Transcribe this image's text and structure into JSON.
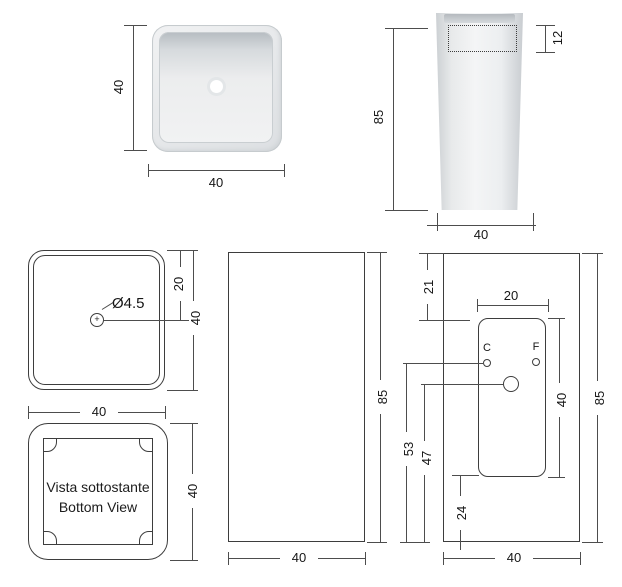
{
  "drawing": {
    "product": "square freestanding washbasin technical drawing",
    "colors": {
      "line": "#3d3d3d",
      "photo_gray": "#e8eaec",
      "background": "#ffffff"
    },
    "views": {
      "top_photo": {
        "dim_height": "40",
        "dim_width": "40"
      },
      "front_photo": {
        "dim_height": "85",
        "dim_rim_depth": "12",
        "dim_width": "40"
      },
      "top_drawing": {
        "hole_label": "Ø4.5",
        "plus_mark": "+",
        "dim_hole_offset": "20",
        "dim_height": "40",
        "dim_width": "40"
      },
      "bottom_drawing": {
        "caption_it": "Vista sottostante",
        "caption_en": "Bottom View",
        "dim_height": "40"
      },
      "side_drawing": {
        "dim_height": "85",
        "dim_width": "40"
      },
      "back_drawing": {
        "dim_top_offset": "21",
        "dim_opening_width": "20",
        "dim_opening_height": "40",
        "dim_height": "85",
        "dim_taps_height": "53",
        "dim_drain_height": "47",
        "dim_bottom_offset": "24",
        "dim_width": "40",
        "label_cold": "C",
        "label_hot": "F"
      }
    }
  }
}
